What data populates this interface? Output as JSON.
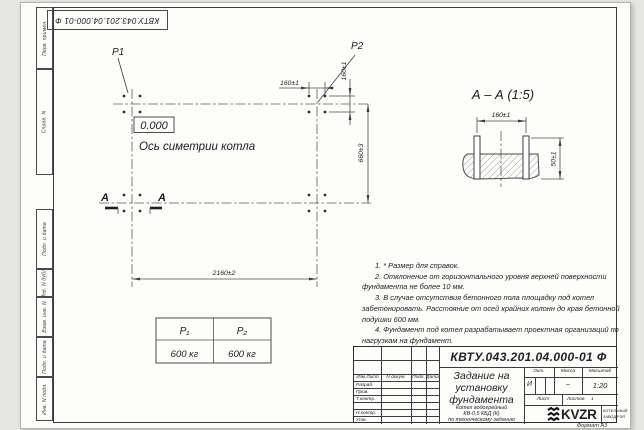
{
  "frame": {
    "top_stamp": "КВТУ.043.201.04.000-01 Ф",
    "side_labels": [
      "Перв. примен.",
      "Справ. N",
      "Подп. и дата",
      "Инв. N дубл.",
      "Взам. инв. N",
      "Подп. и дата",
      "Инв. N подл."
    ],
    "format_label": "Формат А3"
  },
  "plan": {
    "p1": "P1",
    "p2": "P2",
    "elevation": "0.000",
    "axis_label": "Ось симетрии котла",
    "section_letter_1": "A",
    "section_letter_2": "A",
    "dim_bolt_x": "160±1",
    "dim_bolt_y": "160±1",
    "dim_rows": "660±3",
    "dim_cols": "2160±2"
  },
  "section_view": {
    "title": "А – А (1:5)",
    "dim_bolts": "160±1",
    "dim_depth": "50±1"
  },
  "load_table": {
    "h1": "P₁",
    "h2": "P₂",
    "v1": "600 кг",
    "v2": "600 кг"
  },
  "notes": [
    "1. * Размер для справок.",
    "2. Отклонение от горизонтального уровня верхней поверхности фундамента не более 10 мм.",
    "3. В случае отсутствия бетонного пола площадку под котел забетонировать. Расстояние от осей крайних колонн до края бетонной подушки 600 мм.",
    "4. Фундамент под котел разрабатывает проектная организаций по нагрузкам на фундамент."
  ],
  "title_block": {
    "designation": "КВТУ.043.201.04.000-01 Ф",
    "doc_title": "Задание на установку фундамента",
    "subtitle_lines": [
      "Котел водогрейный",
      "КВ-0,5 КБД (К)",
      "по техническому заданию"
    ],
    "cols": [
      "Изм.Лист",
      "N докум.",
      "Подп.",
      "Дата"
    ],
    "rows": [
      "Разраб.",
      "Пров.",
      "Т.контр.",
      "",
      "Н.контр.",
      "Утв."
    ],
    "lit_h": "Лит.",
    "mass_h": "Масса",
    "scale_h": "Масштаб",
    "lit_v": "И",
    "mass_v": "–",
    "scale_v": "1:20",
    "sheet_h": "Лист",
    "sheets_h": "Листов",
    "sheets_v": "1",
    "brand": "KVZR",
    "brand_line1": "КОТЕЛЬНЫЙ",
    "brand_line2": "ЗАВОД РЭП"
  }
}
